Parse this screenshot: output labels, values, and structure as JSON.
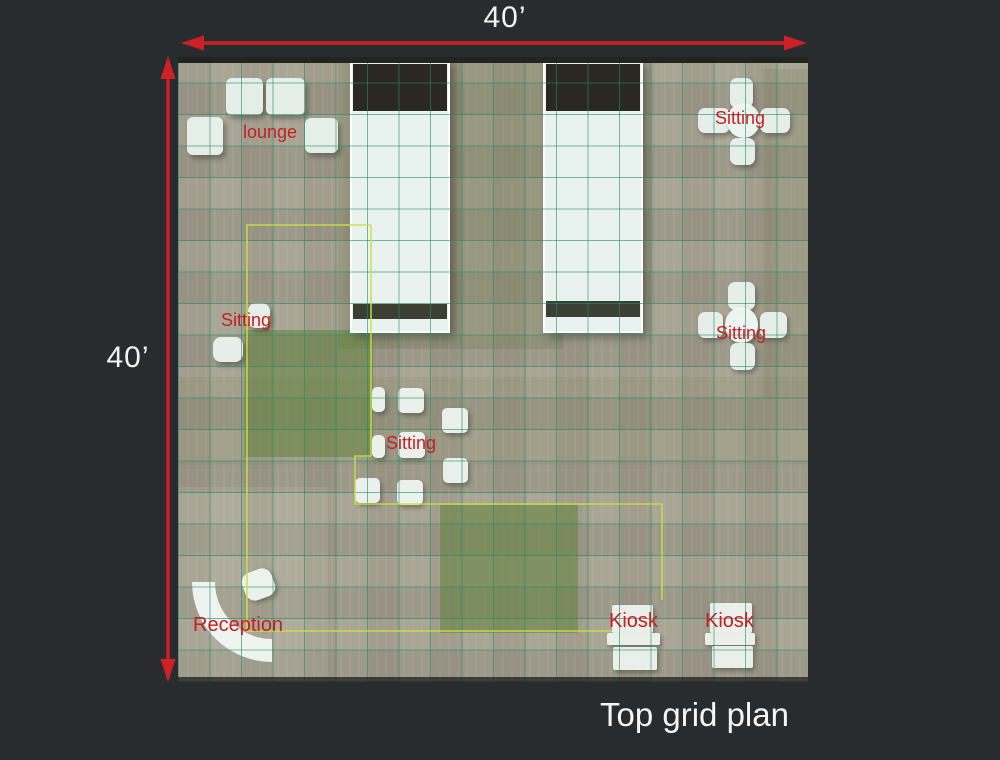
{
  "caption": "Top grid plan",
  "dimensions": {
    "width": "40’",
    "height": "40’"
  },
  "plan": {
    "grid_cells": 20,
    "area_labels": [
      {
        "name": "lounge",
        "text": "lounge"
      },
      {
        "name": "sitting-top-right",
        "text": "Sitting"
      },
      {
        "name": "sitting-left",
        "text": "Sitting"
      },
      {
        "name": "sitting-center",
        "text": "Sitting"
      },
      {
        "name": "sitting-bottom-right",
        "text": "Sitting"
      },
      {
        "name": "reception",
        "text": "Reception"
      },
      {
        "name": "kiosk-1",
        "text": "Kiosk"
      },
      {
        "name": "kiosk-2",
        "text": "Kiosk"
      }
    ]
  },
  "colors": {
    "background": "#282c2f",
    "floor_tan": "#a8a393",
    "grid_teal": "#208c6a",
    "boundary_lime": "#c9e23c",
    "carpet_green": "#688544",
    "structure_white": "#e9f2ee",
    "block_dark": "#2b2721",
    "band_dark": "#3c4034",
    "label_red": "#c41f22",
    "arrow_red": "#cf2025",
    "text_white": "#f2f3f3"
  }
}
